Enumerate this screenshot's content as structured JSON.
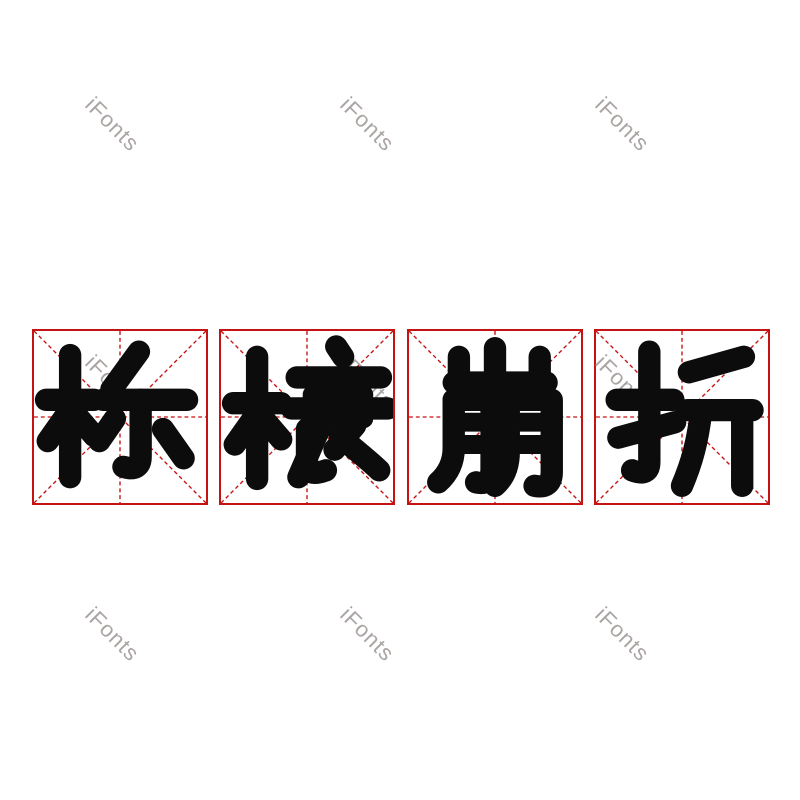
{
  "phrase": "栋榱崩折",
  "cells": [
    {
      "glyph": "栋"
    },
    {
      "glyph": "榱"
    },
    {
      "glyph": "崩"
    },
    {
      "glyph": "折"
    }
  ],
  "watermark": {
    "text": "iFonts",
    "color": "#968f8d"
  },
  "colors": {
    "grid_red": "#c51212",
    "glyph_black": "#0c0c0c",
    "background": "#ffffff"
  }
}
